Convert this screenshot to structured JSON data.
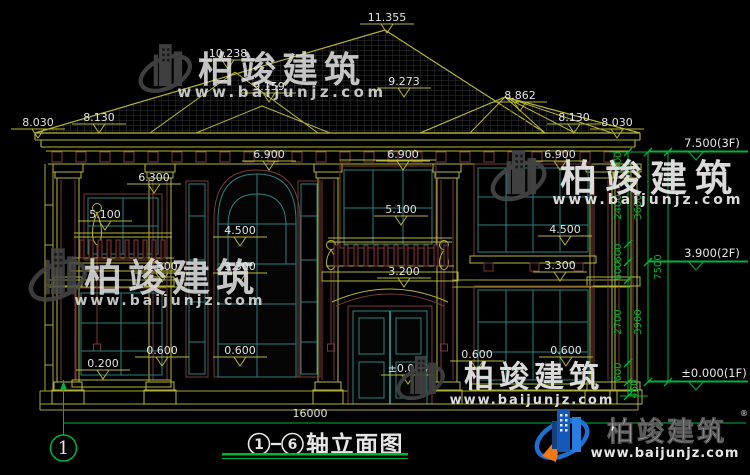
{
  "watermark": {
    "brand": "柏竣建筑",
    "url": "www.baijunjz.com",
    "registered_mark": "®"
  },
  "title_block": {
    "axis_start": "1",
    "axis_end": "6",
    "title": "轴立面图",
    "total_width": "16000"
  },
  "axis_bubble": {
    "label": "1"
  },
  "colors": {
    "background": "#000000",
    "linework_yellow": "#b9b733",
    "accent_maroon": "#7a3939",
    "window_teal": "#2e7f7f",
    "dimension_green": "#00b438",
    "text_white": "#e6e6e6",
    "watermark_gray": "#4a4a4a",
    "watermark_maroon": "#5c1717",
    "logo_blue": "#1e6fd0",
    "logo_orange": "#f07818"
  },
  "annotations": {
    "elevation_labels": [
      {
        "text": "11.355",
        "x": 387,
        "y": 21,
        "marker": true
      },
      {
        "text": "10.238",
        "x": 228,
        "y": 57,
        "marker": true
      },
      {
        "text": "9.159",
        "x": 269,
        "y": 90,
        "marker": true
      },
      {
        "text": "9.273",
        "x": 404,
        "y": 85,
        "marker": true
      },
      {
        "text": "8.862",
        "x": 520,
        "y": 99,
        "marker": true
      },
      {
        "text": "8.030",
        "x": 38,
        "y": 126,
        "marker": true
      },
      {
        "text": "8.130",
        "x": 99,
        "y": 121,
        "marker": true
      },
      {
        "text": "8.130",
        "x": 574,
        "y": 121,
        "marker": true
      },
      {
        "text": "8.030",
        "x": 617,
        "y": 126,
        "marker": true
      },
      {
        "text": "6.900",
        "x": 269,
        "y": 158,
        "marker": true
      },
      {
        "text": "6.900",
        "x": 403,
        "y": 158,
        "marker": true
      },
      {
        "text": "6.900",
        "x": 560,
        "y": 158,
        "marker": true
      },
      {
        "text": "6.300",
        "x": 154,
        "y": 181,
        "marker": true
      },
      {
        "text": "5.100",
        "x": 105,
        "y": 218,
        "marker": true
      },
      {
        "text": "5.100",
        "x": 401,
        "y": 213,
        "marker": true
      },
      {
        "text": "4.500",
        "x": 240,
        "y": 234,
        "marker": true
      },
      {
        "text": "4.500",
        "x": 565,
        "y": 233,
        "marker": true
      },
      {
        "text": "3.300",
        "x": 162,
        "y": 270,
        "marker": true
      },
      {
        "text": "3.300",
        "x": 240,
        "y": 270,
        "marker": true
      },
      {
        "text": "3.300",
        "x": 560,
        "y": 269,
        "marker": true
      },
      {
        "text": "3.200",
        "x": 404,
        "y": 275,
        "marker": true
      },
      {
        "text": "0.600",
        "x": 162,
        "y": 354,
        "marker": true
      },
      {
        "text": "0.600",
        "x": 240,
        "y": 354,
        "marker": true
      },
      {
        "text": "0.600",
        "x": 477,
        "y": 358,
        "marker": true
      },
      {
        "text": "0.600",
        "x": 566,
        "y": 354,
        "marker": true
      },
      {
        "text": "0.200",
        "x": 103,
        "y": 367,
        "marker": true
      },
      {
        "text": "±0.000",
        "x": 408,
        "y": 372,
        "marker": true
      },
      {
        "text": "16000",
        "x": 310,
        "y": 417,
        "marker": false
      }
    ],
    "right_levels": [
      {
        "text": "7.500(3F)",
        "x": 712,
        "y": 147
      },
      {
        "text": "3.900(2F)",
        "x": 712,
        "y": 257
      },
      {
        "text": "±0.000(1F)",
        "x": 714,
        "y": 377
      }
    ],
    "chain_dims": [
      {
        "text": "600",
        "x": 621,
        "y": 161
      },
      {
        "text": "2400",
        "x": 621,
        "y": 207
      },
      {
        "text": "600",
        "x": 621,
        "y": 253
      },
      {
        "text": "600",
        "x": 621,
        "y": 271
      },
      {
        "text": "2700",
        "x": 621,
        "y": 322
      },
      {
        "text": "600",
        "x": 621,
        "y": 372
      },
      {
        "text": "450",
        "x": 637,
        "y": 389
      },
      {
        "text": "3600",
        "x": 641,
        "y": 207
      },
      {
        "text": "3900",
        "x": 641,
        "y": 322
      },
      {
        "text": "7500",
        "x": 661,
        "y": 267
      }
    ]
  }
}
